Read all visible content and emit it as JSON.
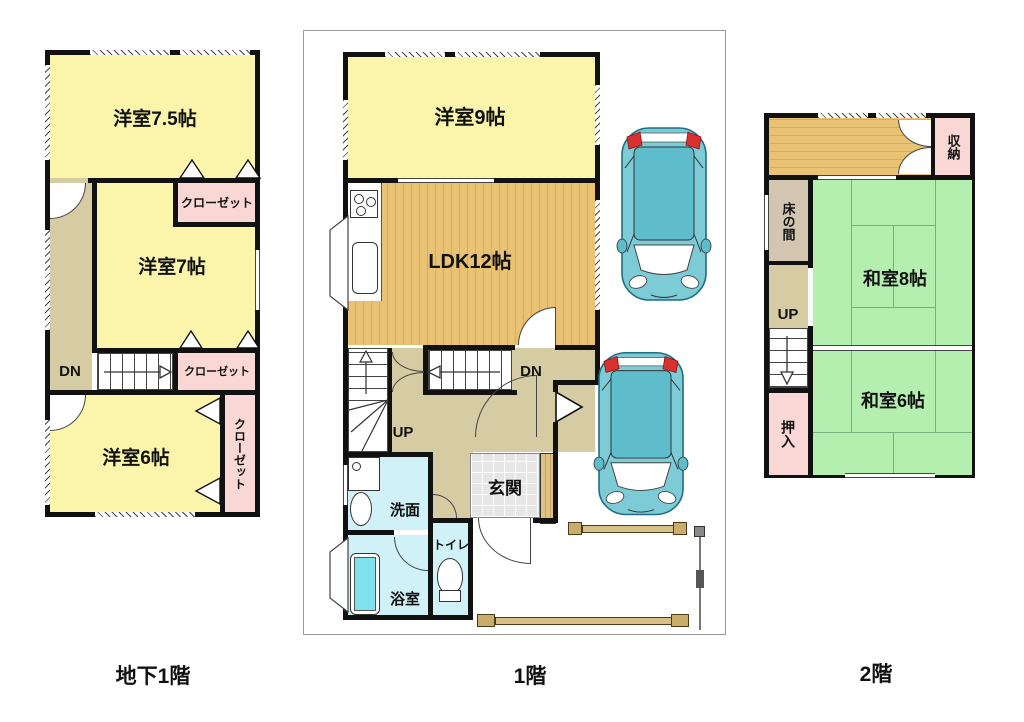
{
  "floors": {
    "b1f": {
      "title": "地下1階",
      "rooms": {
        "room75": "洋室7.5帖",
        "closet1": "クローゼット",
        "room7": "洋室7帖",
        "dn": "DN",
        "closet2": "クローゼット",
        "room6": "洋室6帖",
        "closet3": "クローゼット"
      }
    },
    "f1": {
      "title": "1階",
      "rooms": {
        "room9": "洋室9帖",
        "ldk": "LDK12帖",
        "dn": "DN",
        "up": "UP",
        "senmen": "洗面",
        "bath": "浴室",
        "toilet": "トイレ",
        "genkan": "玄関"
      }
    },
    "f2": {
      "title": "2階",
      "rooms": {
        "shuno": "収納",
        "tokonoma": "床の間",
        "up": "UP",
        "oshiire": "押入",
        "washitsu8": "和室8帖",
        "washitsu6": "和室6帖"
      }
    }
  },
  "icons": [
    "car-icon",
    "bathtub-icon",
    "toilet-icon",
    "sink-icon",
    "stove-icon",
    "door-swing-icon",
    "entrance-arrow-icon",
    "fence-bar-icon",
    "gate-pole-icon"
  ],
  "colors": {
    "western_room_yellow": "#FBF5AB",
    "closet_pink": "#F8D7D5",
    "corridor_tan": "#D5CCA4",
    "wood_floor": "#E9C273",
    "wood_floor_stripe": "#D8AE55",
    "tatami_green": "#B5EFB0",
    "wet_area_blue": "#CFF1F7",
    "bathtub_cyan": "#7FE2EC",
    "car_teal": "#72C8D6",
    "tokonoma_tan": "#D2C6B0",
    "wall_black": "#111111"
  }
}
